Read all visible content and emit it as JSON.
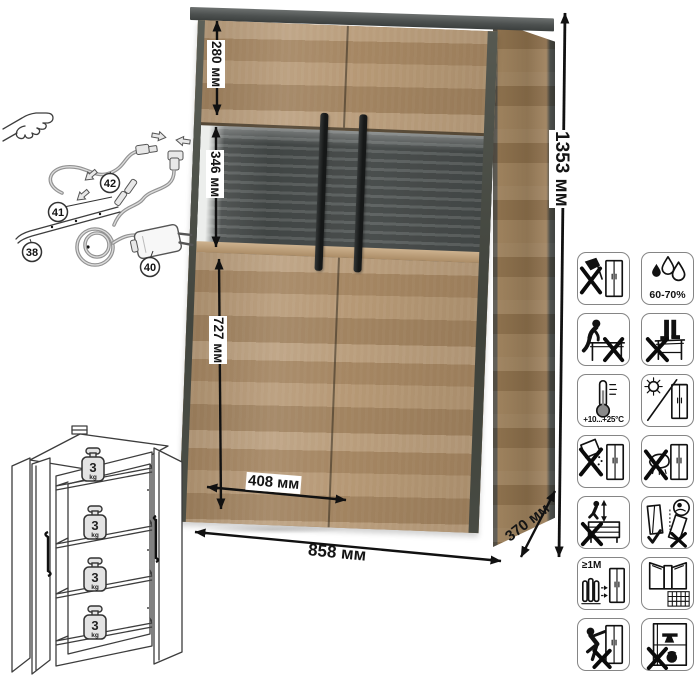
{
  "page": {
    "background_color": "#ffffff"
  },
  "cabinet": {
    "colors": {
      "wood": "#b2936e",
      "wood_side": "#8a6f4c",
      "graphite_edge": "#4a4e4d",
      "glass_back": "#4a4f4e",
      "handle": "#1f2222"
    }
  },
  "dimensions": {
    "total_height": "1353 мм",
    "top_section_height": "280 мм",
    "glass_section_height": "346 мм",
    "bottom_section_height": "727 мм",
    "door_width": "408 мм",
    "total_width": "858 мм",
    "depth": "370 мм"
  },
  "wiring_diagram": {
    "parts": {
      "led_strip": "38",
      "power_adapter": "40",
      "connector": "41",
      "cable": "42"
    }
  },
  "load_diagram": {
    "shelf_loads": [
      {
        "value": "3",
        "unit": "kg"
      },
      {
        "value": "3",
        "unit": "kg"
      },
      {
        "value": "3",
        "unit": "kg"
      },
      {
        "value": "3",
        "unit": "kg"
      }
    ]
  },
  "care_icons": {
    "humidity_label": "60-70%",
    "temperature_label": "+10...+25°C",
    "distance_label": "≥1M",
    "cells": [
      {
        "name": "no-sharp-tools"
      },
      {
        "name": "humidity-range"
      },
      {
        "name": "no-sitting"
      },
      {
        "name": "no-standing"
      },
      {
        "name": "temperature-range"
      },
      {
        "name": "no-direct-sunlight"
      },
      {
        "name": "no-abrasives"
      },
      {
        "name": "no-wet-cleaning"
      },
      {
        "name": "no-jumping"
      },
      {
        "name": "carry-upright"
      },
      {
        "name": "keep-1m-from-heat"
      },
      {
        "name": "ventilate-room"
      },
      {
        "name": "no-dragging"
      },
      {
        "name": "no-overloading"
      }
    ]
  }
}
